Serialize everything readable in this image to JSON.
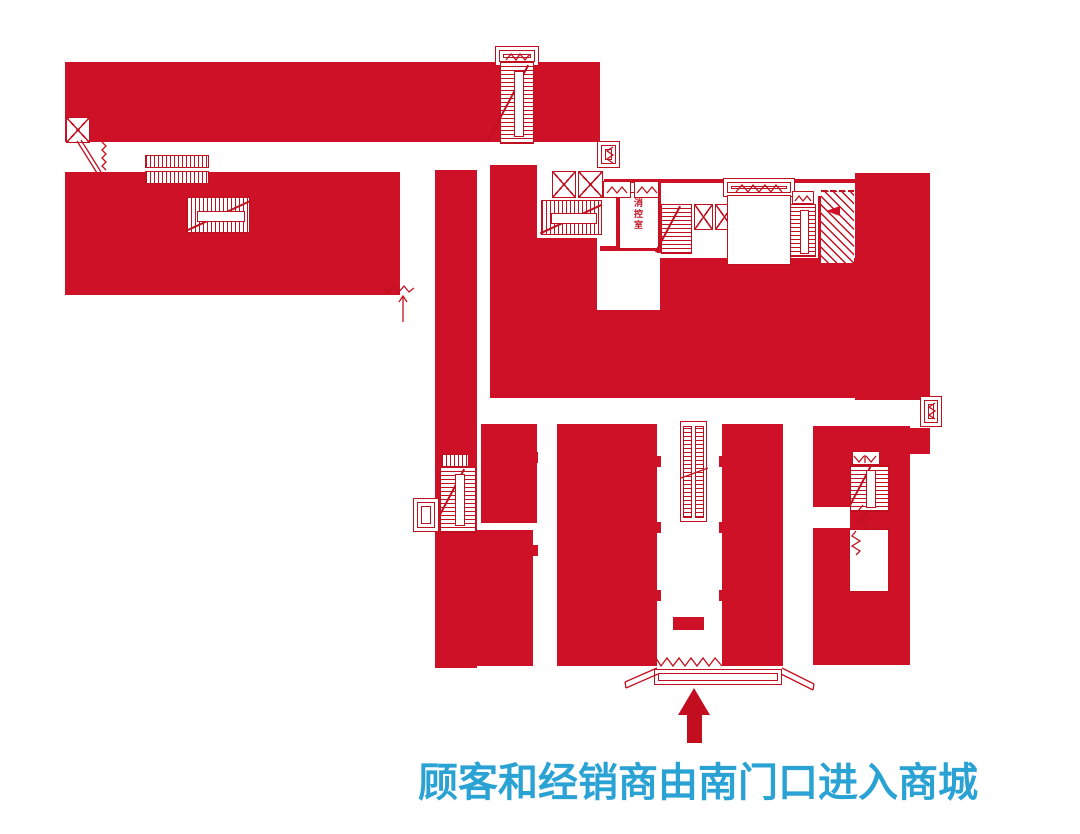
{
  "caption": {
    "text": "顾客和经销商由南门口进入商城"
  },
  "labels": {
    "fire_control_room": "消控室"
  },
  "colors": {
    "plan_red": "#CE1126",
    "line_red": "#C0101F",
    "arrow_red": "#C30E20",
    "caption_blue": "#2BA2D4",
    "background": "#FFFFFF"
  },
  "icons": {
    "elevator": "white box with X cross",
    "stairs": "ladder hatch with center bar and diagonal",
    "escalator": "double ladder hatch strips",
    "ramp": "diagonal hatch field",
    "entrance_threshold": "zigzag line",
    "door": "angled leaf lines",
    "direction_arrow": "solid up arrow"
  }
}
